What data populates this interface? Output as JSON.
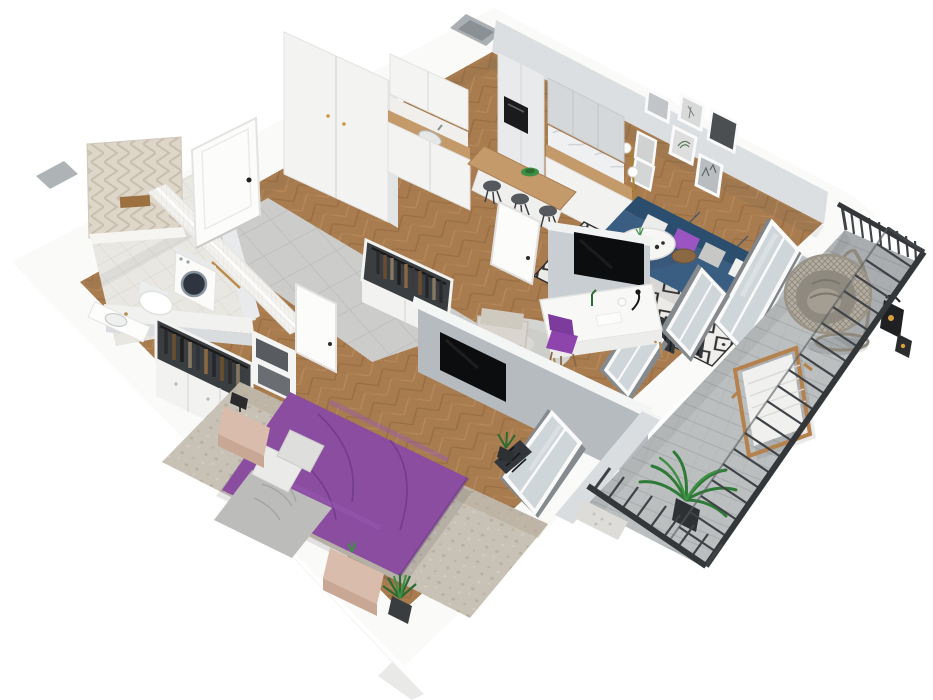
{
  "meta": {
    "view": "isometric-3d-apartment-cutaway-floor-plan",
    "width": 933,
    "height": 700,
    "background": "#ffffff"
  },
  "palette": {
    "outer_wall": "#fafaf9",
    "skirt": "#f1f1f0",
    "inner_face": "#dcdfe2",
    "wall_face": "#c9ced2",
    "tv_wall": "#b6bbbf",
    "wood_floor": "#a87c4f",
    "hall_tile": "#cccccb",
    "bath_tile": "#e9e7e2",
    "bed_purple": "#8a4da0",
    "pillow_purple": "#9a55c2",
    "chair_purple": "#8e44ad",
    "sofa_dark": "#2c4e6e",
    "sofa_blue": "#3a5d82",
    "rug_white": "#efeeec",
    "rug_black": "#2e2e2e",
    "bedroom_rug": "#c8c1b5",
    "nightstand_pink": "#d9bcab",
    "throw_gray": "#bcbcba",
    "counter_wood": "#c59a6b",
    "cabinet_white": "#f3f3f2",
    "cabinet_gray": "#d5d8da",
    "appliance_black": "#1a1b1d",
    "tv_black": "#0c0d0e",
    "balcony_floor": "#bcbfc0",
    "railing": "#3a3d40",
    "radiator": "#33363a",
    "plant_green": "#3f8f45",
    "plant_dark": "#2e6b33",
    "egg_chair_rattan": "#b3ada1",
    "egg_chair_cushion": "#8f8a80",
    "glass": "#cfd6da",
    "frame_white": "#fafafa",
    "lounger_wood": "#b5814c",
    "accent_wall_beige": "#ddd6c9",
    "door_white": "#fcfcfb"
  },
  "scene": {
    "rooms": [
      {
        "id": "bathroom",
        "label": "bathroom",
        "floor": "light-tile"
      },
      {
        "id": "entry-hall",
        "label": "entry-hall",
        "floor": "gray-tile"
      },
      {
        "id": "kitchen",
        "label": "kitchen",
        "floor": "herringbone-wood"
      },
      {
        "id": "living-room",
        "label": "living-room",
        "floor": "herringbone-wood"
      },
      {
        "id": "study-nook",
        "label": "study-nook",
        "floor": "herringbone-wood"
      },
      {
        "id": "wardrobe",
        "label": "wardrobe",
        "floor": "herringbone-wood"
      },
      {
        "id": "bedroom",
        "label": "bedroom",
        "floor": "herringbone-wood"
      },
      {
        "id": "balcony",
        "label": "balcony",
        "floor": "gray-planks"
      }
    ],
    "furniture": {
      "bathroom": [
        "washing-machine",
        "wall-hung-toilet",
        "vanity-sink",
        "shower-half-wall",
        "herringbone-accent-wall"
      ],
      "entry-hall": [
        "entry-door",
        "tall-white-wardrobe",
        "open-clothes-rack"
      ],
      "kitchen": [
        "white-cabinets",
        "gray-upper-cabinets",
        "wood-countertop",
        "sink",
        "coffee-machine",
        "peninsula-island",
        "bar-stools",
        "fruit-bowl"
      ],
      "living-room": [
        "gallery-wall-frames",
        "floor-lamp",
        "navy-corner-sofa",
        "throw-pillows",
        "round-coffee-table",
        "side-table",
        "diamond-pattern-rug",
        "balcony-door",
        "radiators"
      ],
      "study-nook": [
        "partition-wall-tv",
        "white-desk",
        "purple-desk-chairs",
        "armchair",
        "round-gray-rug",
        "wall-tv"
      ],
      "bedroom": [
        "double-bed-purple-duvet",
        "gray-throw",
        "pillows",
        "nightstands",
        "open-closet-clothes",
        "storage-boxes",
        "window",
        "radiator",
        "plants"
      ],
      "balcony": [
        "metal-railing",
        "hanging-egg-chair",
        "wooden-lounger",
        "lanterns",
        "potted-palm",
        "pebble-planter"
      ]
    }
  }
}
